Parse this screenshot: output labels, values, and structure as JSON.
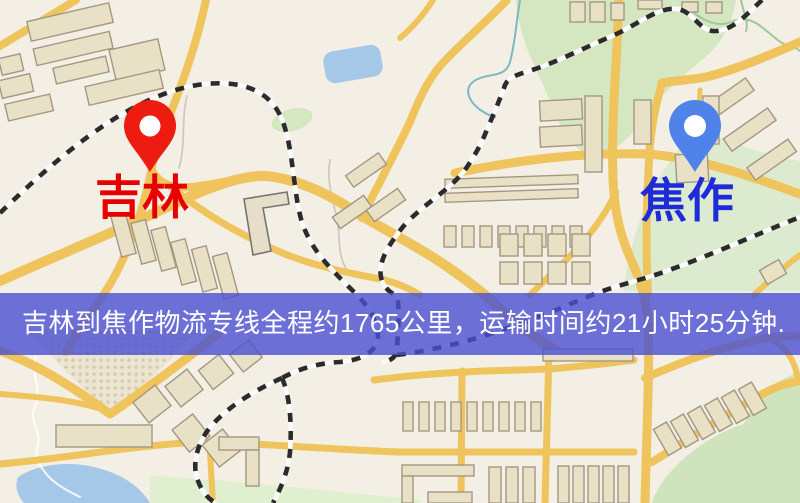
{
  "map": {
    "origin_marker": {
      "label": "吉林",
      "icon": "map-pin-icon"
    },
    "destination_marker": {
      "label": "焦作",
      "icon": "map-pin-icon"
    }
  },
  "banner": {
    "text": "吉林到焦作物流专线全程约1765公里，运输时间约21小时25分钟."
  },
  "colors": {
    "map_bg": "#f3efe4",
    "road": "#efc45c",
    "park": "#d5e7c0",
    "water": "#a5c8e9",
    "building": "#e9e1c6",
    "rail_dark": "#2b2b2b",
    "rail_light": "#fbfbfb",
    "origin_pin": "#ed1b10",
    "origin_label": "#e60000",
    "destination_pin": "#4f83ea",
    "destination_label": "#1e2bd8",
    "banner_bg": "rgba(74,80,210,0.8)",
    "banner_text": "#ffffff"
  }
}
